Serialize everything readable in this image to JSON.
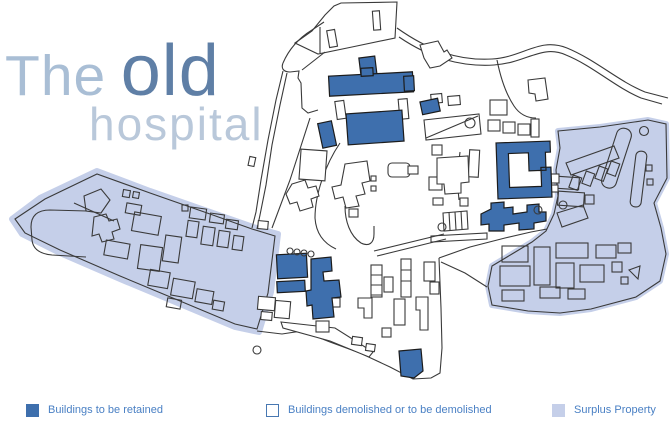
{
  "title": {
    "prefix": "The",
    "emphasis": "old",
    "line2": "hospital"
  },
  "legend": {
    "items": [
      {
        "label": "Buildings to be retained",
        "style": "retained"
      },
      {
        "label": "Buildings demolished or to be demolished",
        "style": "demolished"
      },
      {
        "label": "Surplus Property",
        "style": "surplus"
      }
    ]
  },
  "palette": {
    "retained_fill": "#3e6fad",
    "surplus_fill": "#c5cfe9",
    "outline": "#3a3a3a",
    "title_light": "#a9bed5",
    "title_lighter": "#b9c8da",
    "title_dark": "#5f7fa6",
    "legend_text": "#4a80c4",
    "legend_border": "#4878b2"
  }
}
